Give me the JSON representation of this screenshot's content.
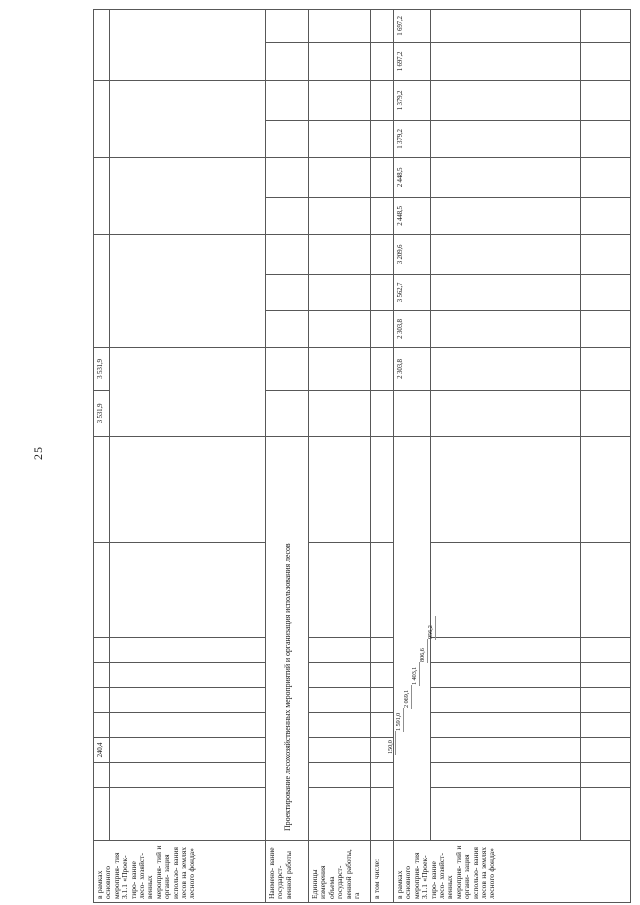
{
  "page_number": "25",
  "colors": {
    "paper": "#ffffff",
    "ink": "#161616",
    "grid_line": "#585858",
    "outer_border": "#1f1f1f"
  },
  "table": {
    "section_header": "в рамках основного мероприя- тия 3.1.1 «Проек- тиро- вание лесо- хозяйст- венных мероприя- тий и органи- зация использо- вания лесов на землях лесного фонда»",
    "work_name_label": "Наимено- вание государст- венной работы",
    "work_name_value": "Проектирование лесохозяйственных мероприятий и организация использования лесов",
    "units_label": "Единицы измерения объема государст- венной работы, га",
    "including_label": "в том числе:",
    "header_row_values": [
      "240,4",
      "3 531,9",
      "3 531,9"
    ],
    "staircase_values": [
      "150,0",
      "1 591,0",
      "2 069,1",
      "1 403,1",
      "806,6",
      "956,2"
    ],
    "volume_values": [
      "2 303,8",
      "2 303,8",
      "3 562,7",
      "3 209,6",
      "2 448,5",
      "2 448,5",
      "1 379,2",
      "1 379,2",
      "1 697,2",
      "1 697,2"
    ]
  }
}
